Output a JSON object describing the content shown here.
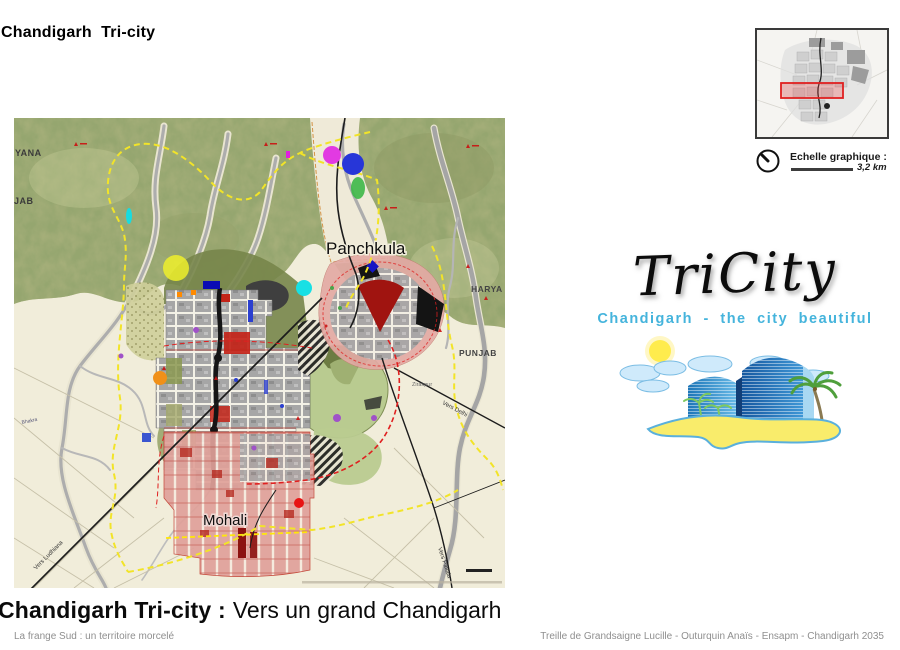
{
  "header": {
    "title": "Chandigarh  Tri-city"
  },
  "caption": {
    "bold": "Chandigarh Tri-city :",
    "regular": "Vers un grand Chandigarh",
    "subtitle": "La frange Sud : un territoire morcelé"
  },
  "footer": {
    "credits": "Treille de Grandsaigne Lucille - Outurquin Anaïs - Ensapm - Chandigarh 2035"
  },
  "scale": {
    "label": "Echelle graphique :",
    "value": "3,2 km"
  },
  "logo": {
    "title": "TriCity",
    "tagline": "Chandigarh - the city beautiful"
  },
  "map": {
    "labels": {
      "panchkula": "Panchkula",
      "mohali": "Mohali",
      "haryana_partial_left": "YANA",
      "punjab_partial_left": "JAB",
      "haryana_right": "HARYA",
      "punjab_right": "PUNJAB",
      "zirakpur": "Zirakpur",
      "vers_delhi": "Vers Delhi",
      "vers_patiala": "Vers Patiala",
      "vers_ludhiana": "Vers Ludhiana",
      "canal": "Bhakra"
    }
  },
  "colors": {
    "boundary_yellow": "#f2e428",
    "alert_red": "#e02020",
    "urban_gray": "#a6a6a6",
    "urban_pink": "#e0a19a",
    "hills_green": "#a8b07b",
    "tagline_blue": "#45b4dc",
    "inset_highlight": "#e02020"
  }
}
